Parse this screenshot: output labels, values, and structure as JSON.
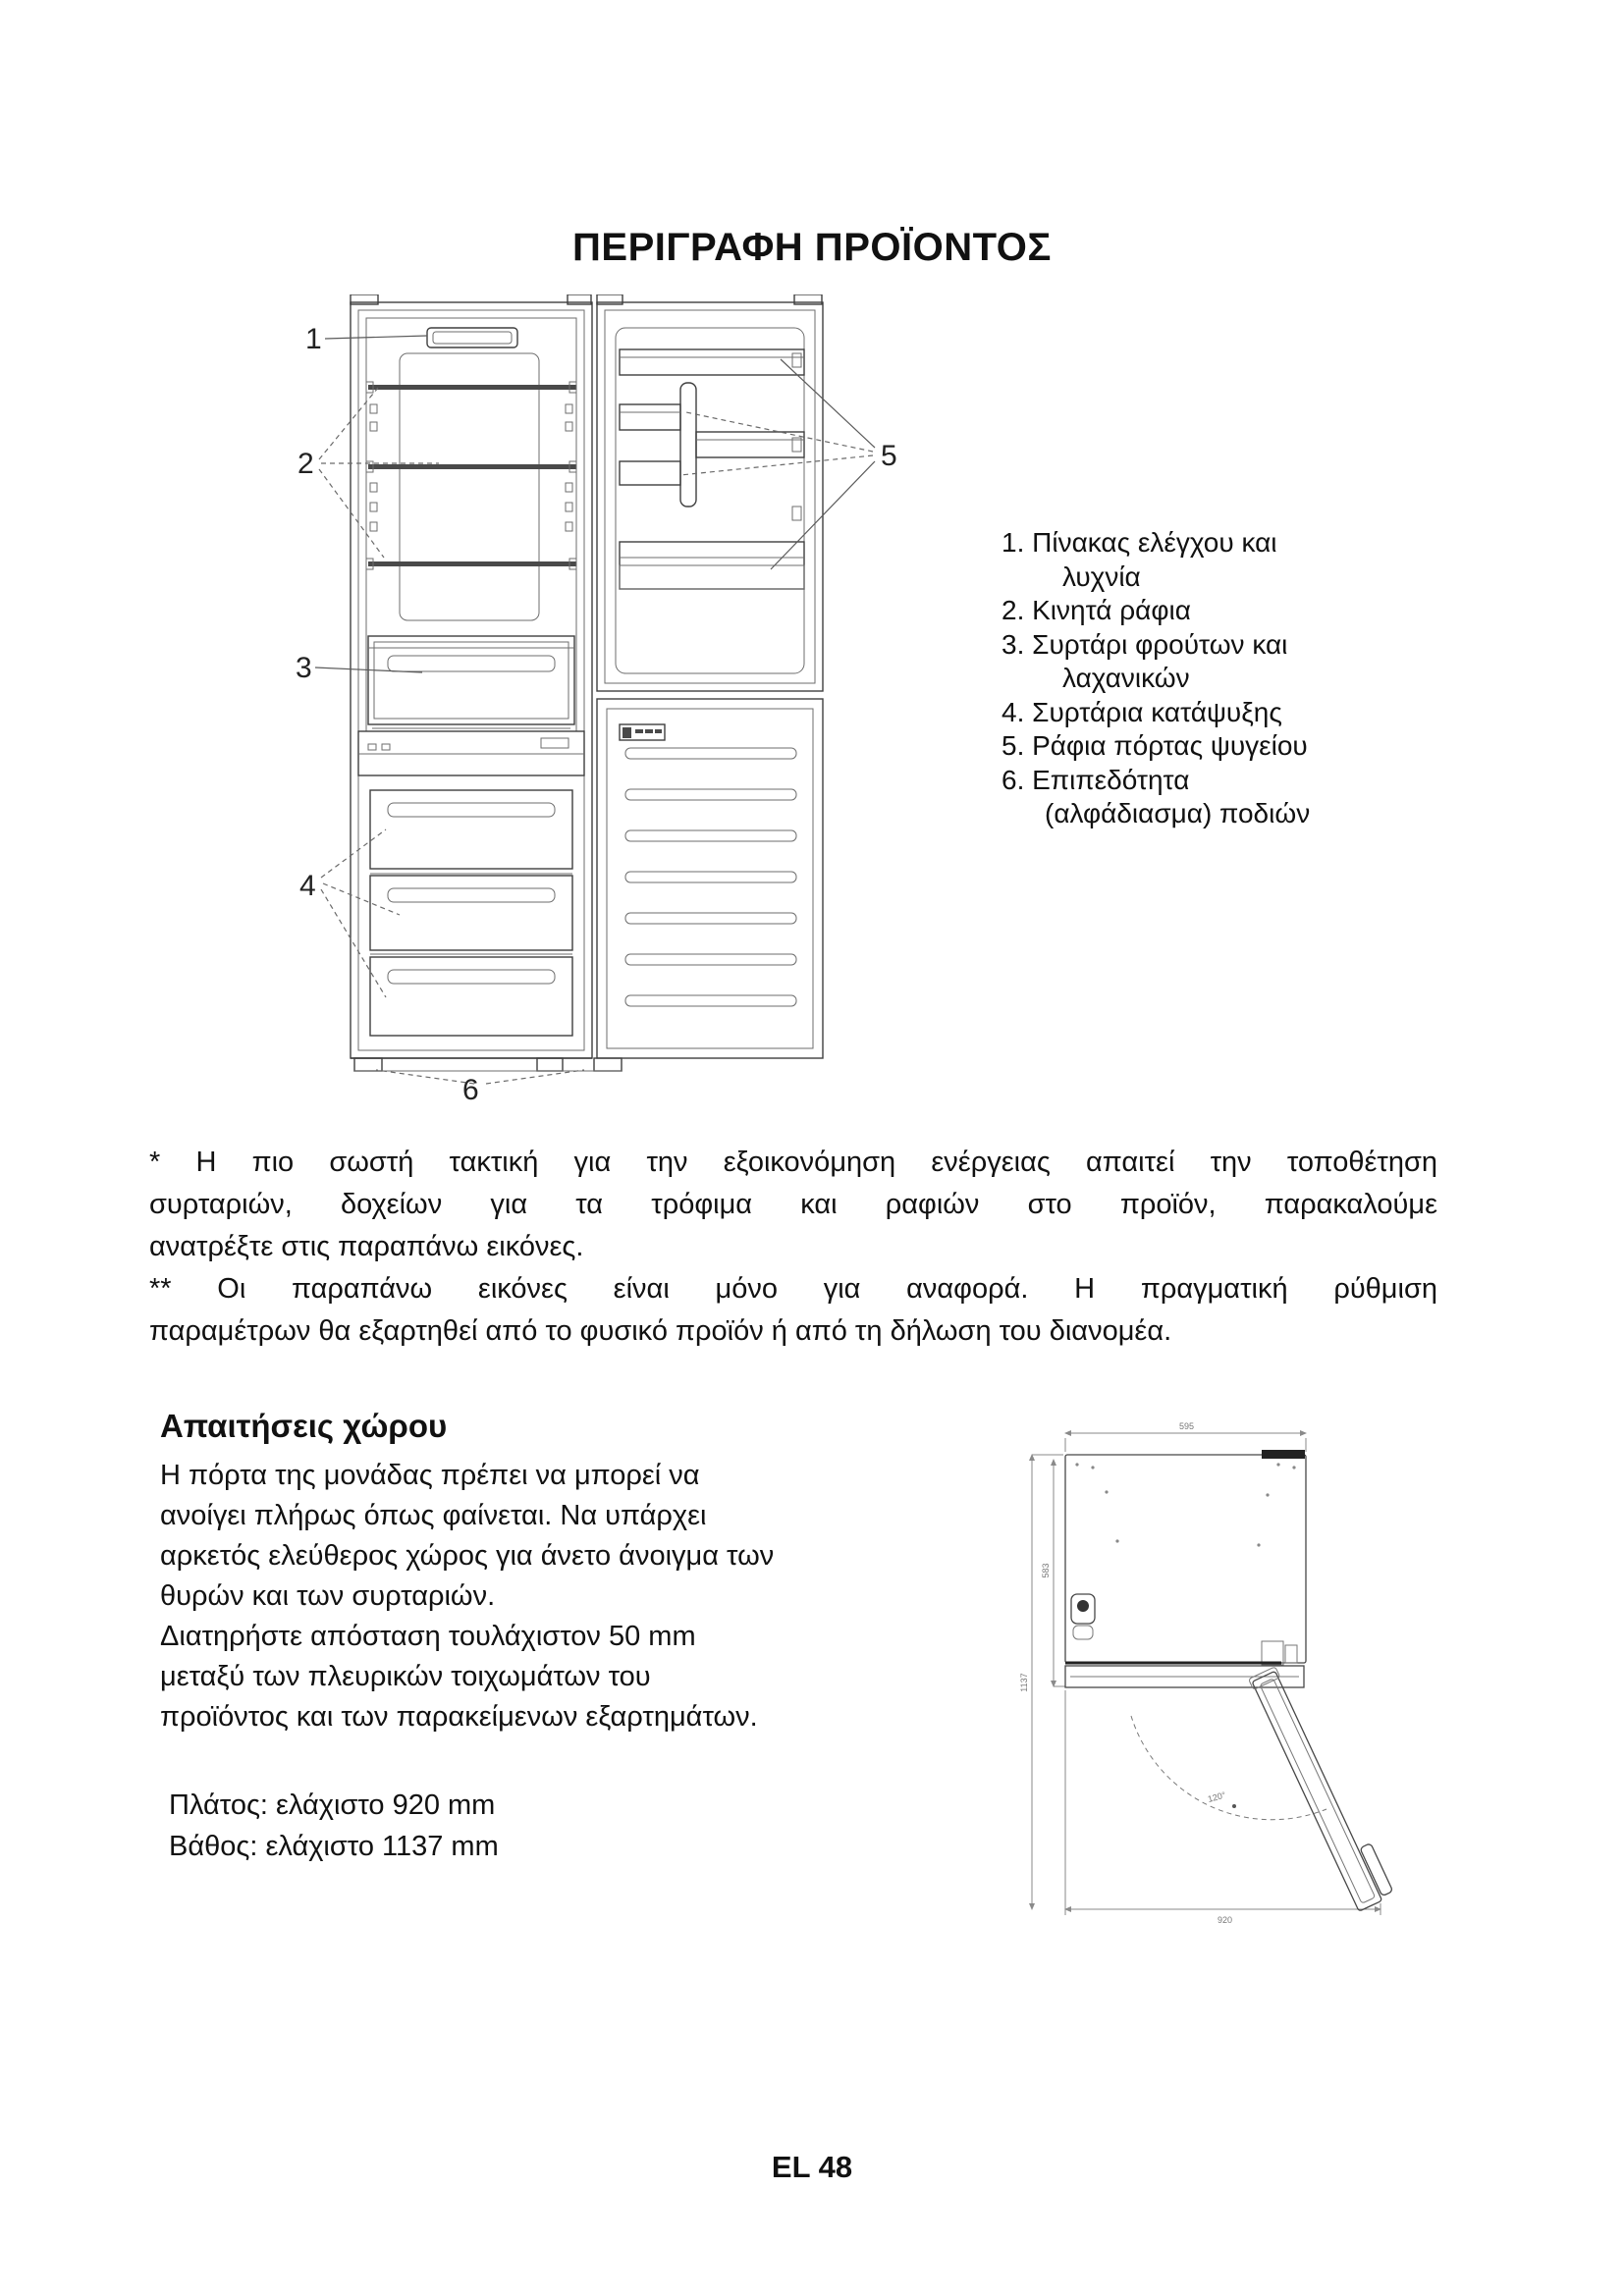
{
  "page": {
    "title": "ΠΕΡΙΓΡΑΦΗ ΠΡΟΪΟΝΤΟΣ",
    "footer": "EL 48"
  },
  "product_diagram": {
    "callouts": [
      "1",
      "2",
      "3",
      "4",
      "5",
      "6"
    ]
  },
  "parts_list": {
    "items": [
      {
        "lines": [
          "1. Πίνακας ελέγχου και",
          "λυχνία"
        ]
      },
      {
        "lines": [
          "2. Κινητά ράφια"
        ]
      },
      {
        "lines": [
          "3. Συρτάρι φρούτων και",
          "λαχανικών"
        ]
      },
      {
        "lines": [
          "4. Συρτάρια κατάψυξης"
        ]
      },
      {
        "lines": [
          "5. Ράφια πόρτας ψυγείου"
        ]
      },
      {
        "lines": [
          "6. Επιπεδότητα",
          "(αλφάδιασμα) ποδιών"
        ]
      }
    ]
  },
  "notes": {
    "note1_lines": [
      "* Η πιο σωστή τακτική για την εξοικονόμηση ενέργειας απαιτεί την τοποθέτηση",
      "συρταριών, δοχείων για τα τρόφιμα και ραφιών στο προϊόν, παρακαλούμε",
      "ανατρέξτε στις παραπάνω εικόνες."
    ],
    "note2_lines": [
      "** Οι παραπάνω εικόνες είναι μόνο για αναφορά. Η πραγματική ρύθμιση",
      "παραμέτρων θα εξαρτηθεί από το φυσικό προϊόν ή από τη δήλωση του διανομέα."
    ]
  },
  "space_requirements": {
    "heading": "Απαιτήσεις χώρου",
    "body_lines": [
      "Η πόρτα της μονάδας πρέπει να μπορεί να",
      "ανοίγει πλήρως όπως φαίνεται. Να υπάρχει",
      "αρκετός ελεύθερος χώρος για άνετο άνοιγμα των",
      "θυρών και των συρταριών.",
      "Διατηρήστε απόσταση τουλάχιστον 50 mm",
      "μεταξύ των πλευρικών τοιχωμάτων του",
      "προϊόντος και των παρακείμενων εξαρτημάτων."
    ],
    "width_note": "Πλάτος: ελάχιστο 920 mm",
    "depth_note": "Βάθος: ελάχιστο 1137 mm",
    "diagram": {
      "cabinet_width": "595",
      "cabinet_depth": "583",
      "min_depth": "1137",
      "min_width": "920",
      "door_angle": "120°"
    }
  }
}
